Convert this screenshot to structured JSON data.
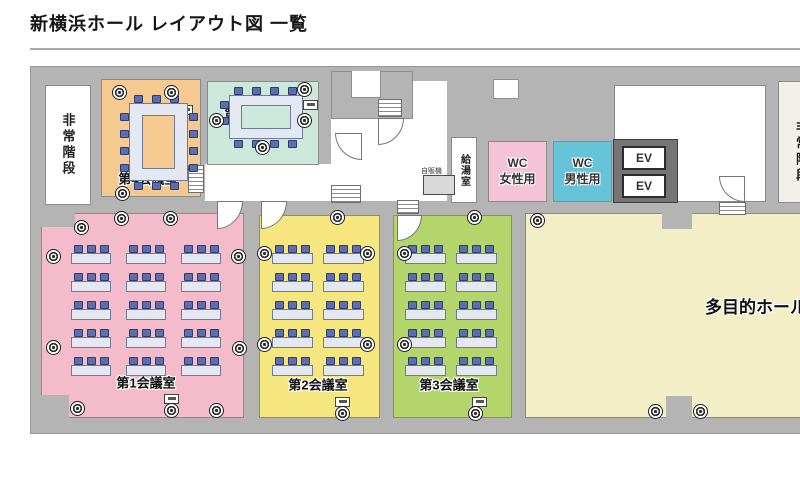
{
  "page": {
    "title": "新横浜ホール レイアウト図 一覧"
  },
  "colors": {
    "room1": "#f4bbca",
    "room2": "#f5e680",
    "room3": "#b3d56c",
    "room4": "#f6c990",
    "room5": "#cbe8db",
    "hall": "#f2eec6",
    "wc_women": "#f6c3d6",
    "wc_men": "#66c4d8",
    "wall": "#b4b4b4",
    "chair": "#5b6fb0",
    "table": "#e3e8f3"
  },
  "rooms": {
    "room1": {
      "label": "第1会議室",
      "seats": {
        "rows": 5,
        "cols": 3,
        "chairs_per_table": 3
      }
    },
    "room2": {
      "label": "第2会議室",
      "seats": {
        "rows": 5,
        "cols": 2,
        "chairs_per_table": 3
      }
    },
    "room3": {
      "label": "第3会議室",
      "seats": {
        "rows": 5,
        "cols": 2,
        "chairs_per_table": 3
      }
    },
    "room4": {
      "label": "第4会議室",
      "conference": {
        "chairs_top": 3,
        "chairs_bottom": 3,
        "chairs_left": 4,
        "chairs_right": 4
      }
    },
    "room5": {
      "label": "第5会議室",
      "conference": {
        "chairs_top": 4,
        "chairs_bottom": 4,
        "chairs_left": 2,
        "chairs_right": 0
      }
    },
    "hall": {
      "label": "多目的ホール"
    },
    "stairs_left": {
      "label": "非常階段"
    },
    "stairs_right": {
      "label": "非常階段"
    },
    "kitchenette": {
      "label": "給湯室"
    },
    "vending": {
      "label": "自販機"
    },
    "wc_women": {
      "line1": "WC",
      "line2": "女性用"
    },
    "wc_men": {
      "line1": "WC",
      "line2": "男性用"
    },
    "elevator": {
      "label": "EV"
    }
  }
}
